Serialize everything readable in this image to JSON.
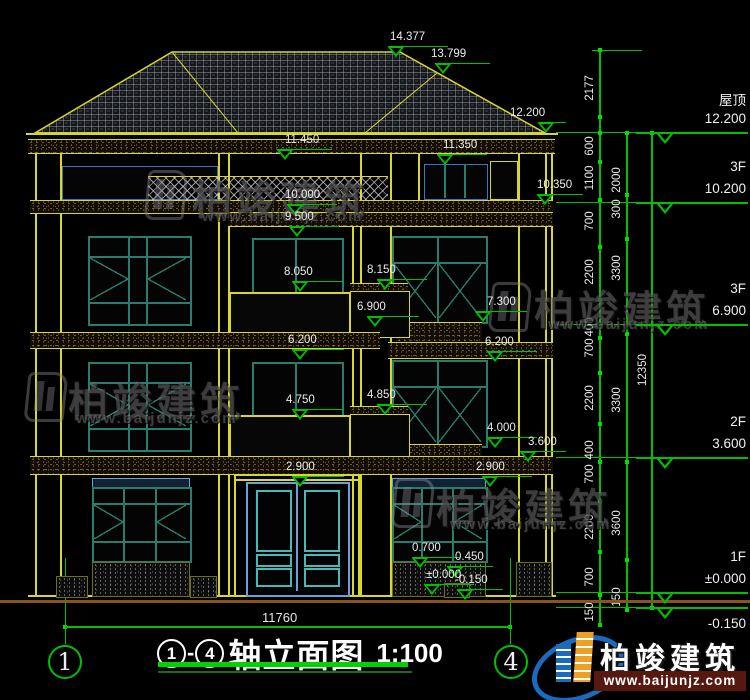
{
  "colors": {
    "green": "#00c000",
    "yellow": "#d8d82a",
    "teal": "#2a7c6c",
    "door_blue": "#6f9fd8",
    "panel_teal": "#49b8b8",
    "logo_blue": "#1a6bbf",
    "logo_orange": "#f0a020",
    "url_strip": "#56180f"
  },
  "spot_levels": [
    {
      "text": "14.377",
      "x": 396,
      "y": 57,
      "lw": 60,
      "tox": -6
    },
    {
      "text": "13.799",
      "x": 443,
      "y": 74,
      "lw": 55,
      "tox": -12
    },
    {
      "text": "12.200",
      "x": 546,
      "y": 133,
      "lw": 28,
      "tox": -36
    },
    {
      "text": "11.450",
      "x": 285,
      "y": 160,
      "lw": 55,
      "tox": 0
    },
    {
      "text": "11.350",
      "x": 445,
      "y": 165,
      "lw": 50,
      "tox": -2
    },
    {
      "text": "10.000",
      "x": 295,
      "y": 215,
      "lw": 50,
      "tox": -10
    },
    {
      "text": "10.350",
      "x": 545,
      "y": 205,
      "lw": 46,
      "tox": -8
    },
    {
      "text": "9.500",
      "x": 297,
      "y": 237,
      "lw": 50,
      "tox": -12
    },
    {
      "text": "8.050",
      "x": 300,
      "y": 292,
      "lw": 52,
      "tox": -16
    },
    {
      "text": "8.150",
      "x": 385,
      "y": 290,
      "lw": 50,
      "tox": -18
    },
    {
      "text": "7.300",
      "x": 483,
      "y": 322,
      "lw": 52,
      "tox": 4
    },
    {
      "text": "6.900",
      "x": 375,
      "y": 327,
      "lw": 52,
      "tox": -18
    },
    {
      "text": "6.200",
      "x": 300,
      "y": 360,
      "lw": 52,
      "tox": -12
    },
    {
      "text": "6.200",
      "x": 495,
      "y": 362,
      "lw": 50,
      "tox": -10
    },
    {
      "text": "4.750",
      "x": 300,
      "y": 420,
      "lw": 52,
      "tox": -14
    },
    {
      "text": "4.850",
      "x": 385,
      "y": 415,
      "lw": 50,
      "tox": -18
    },
    {
      "text": "4.000",
      "x": 495,
      "y": 448,
      "lw": 50,
      "tox": -8
    },
    {
      "text": "3.600",
      "x": 528,
      "y": 462,
      "lw": 46,
      "tox": 0
    },
    {
      "text": "2.900",
      "x": 300,
      "y": 487,
      "lw": 52,
      "tox": -14
    },
    {
      "text": "2.900",
      "x": 490,
      "y": 487,
      "lw": 50,
      "tox": -14
    },
    {
      "text": "0.700",
      "x": 420,
      "y": 568,
      "lw": 48,
      "tox": -8
    },
    {
      "text": "0.450",
      "x": 455,
      "y": 577,
      "lw": 46,
      "tox": 0
    },
    {
      "text": "±0.000",
      "x": 432,
      "y": 595,
      "lw": 50,
      "tox": -6
    },
    {
      "text": "-0.150",
      "x": 465,
      "y": 600,
      "lw": 46,
      "tox": -10
    }
  ],
  "floor_levels": [
    {
      "name": "屋顶",
      "elev": "12.200",
      "y": 133
    },
    {
      "name": "3F",
      "elev": "10.200",
      "y": 203
    },
    {
      "name": "3F",
      "elev": "6.900",
      "y": 325
    },
    {
      "name": "2F",
      "elev": "3.600",
      "y": 458
    },
    {
      "name": "1F",
      "elev": "±0.000",
      "y": 593
    },
    {
      "name": "",
      "elev": "-0.150",
      "y": 608,
      "below": true
    }
  ],
  "dims_outer": [
    {
      "v": "2177",
      "y": 88
    },
    {
      "v": "600",
      "y": 146
    },
    {
      "v": "1100",
      "y": 178
    },
    {
      "v": "700",
      "y": 221
    },
    {
      "v": "2200",
      "y": 272
    },
    {
      "v": "400",
      "y": 327
    },
    {
      "v": "700",
      "y": 348
    },
    {
      "v": "2200",
      "y": 398
    },
    {
      "v": "400",
      "y": 450
    },
    {
      "v": "700",
      "y": 474
    },
    {
      "v": "2200",
      "y": 527
    },
    {
      "v": "700",
      "y": 577
    },
    {
      "v": "150",
      "y": 612
    }
  ],
  "dims_inner": [
    {
      "v": "2000",
      "y": 180
    },
    {
      "v": "300",
      "y": 209
    },
    {
      "v": "3300",
      "y": 268
    },
    {
      "v": "3300",
      "y": 400
    },
    {
      "v": "3600",
      "y": 523
    },
    {
      "v": "150",
      "y": 597
    }
  ],
  "dim_overall": {
    "v": "12350",
    "y": 370
  },
  "dim_width": {
    "v": "11760"
  },
  "axis_bubbles": [
    {
      "label": "1"
    },
    {
      "label": "4"
    }
  ],
  "title_block": {
    "from": "1",
    "dash": "-",
    "to": "4",
    "text": "轴立面图",
    "scale": "1:100"
  },
  "watermarks": [
    {
      "name": "柏竣建筑",
      "url": "www.baijunjz.com",
      "ix": 146,
      "iy": 170,
      "nx": 192,
      "ny": 168,
      "ux": 202,
      "uy": 208
    },
    {
      "name": "柏竣建筑",
      "url": "www.baijunjz.com",
      "ix": 490,
      "iy": 282,
      "nx": 534,
      "ny": 278,
      "ux": 548,
      "uy": 316
    },
    {
      "name": "柏竣建筑",
      "url": "www.baijunjz.com",
      "ix": 26,
      "iy": 372,
      "nx": 68,
      "ny": 370,
      "ux": 76,
      "uy": 410
    },
    {
      "name": "柏竣建筑",
      "url": "www.baijunjz.com",
      "ix": 393,
      "iy": 478,
      "nx": 436,
      "ny": 476,
      "ux": 450,
      "uy": 516
    }
  ],
  "logo": {
    "name": "柏竣建筑",
    "url": "www.baijunjz.com"
  }
}
